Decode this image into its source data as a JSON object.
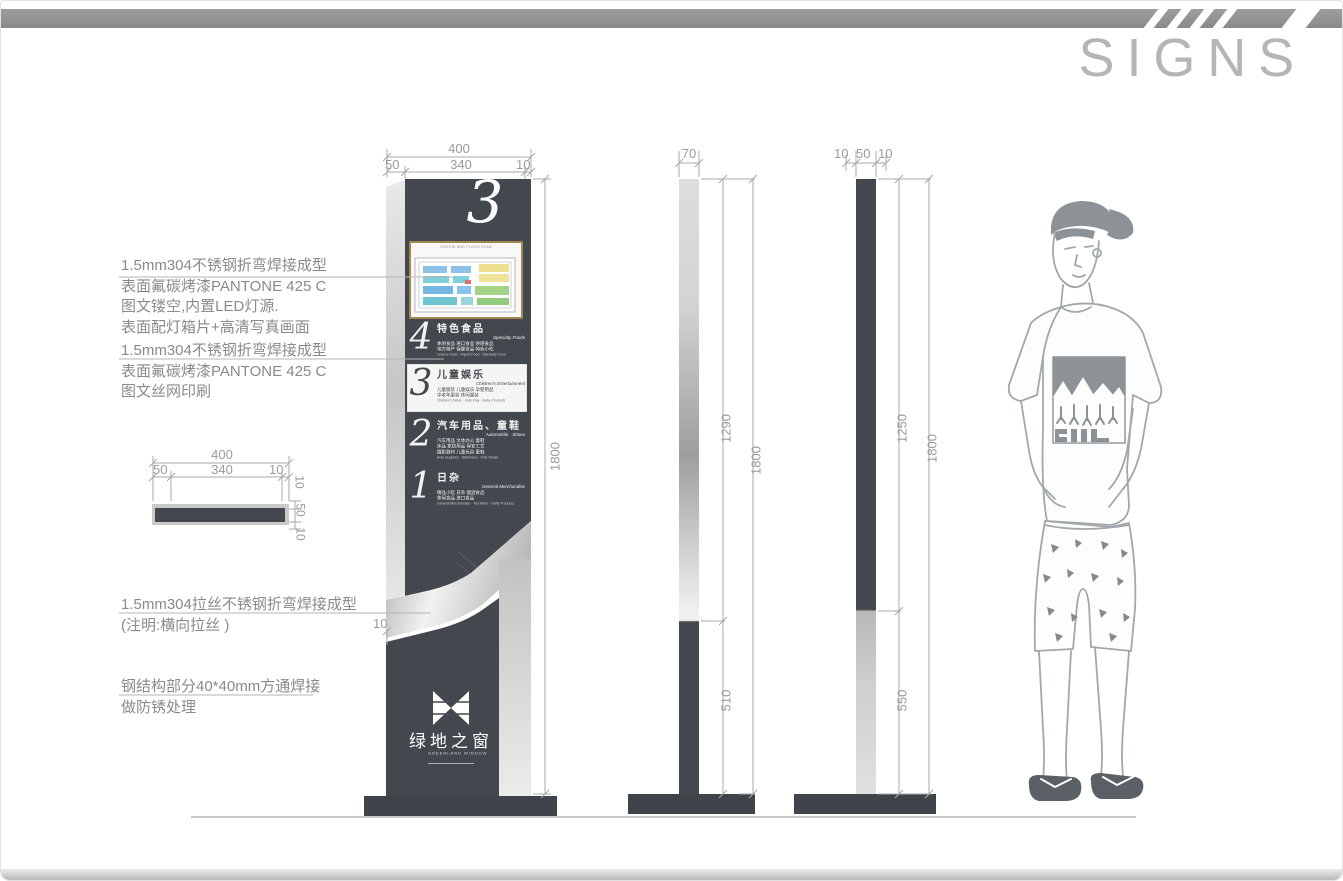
{
  "header": {
    "title": "SIGNS"
  },
  "annotations": {
    "a1": {
      "l1": "1.5mm304不锈钢折弯焊接成型",
      "l2": "表面氟碳烤漆PANTONE 425 C",
      "l3": "图文镂空,内置LED灯源.",
      "l4": "表面配灯箱片+高清写真画面"
    },
    "a2": {
      "l1": "1.5mm304不锈钢折弯焊接成型",
      "l2": "表面氟碳烤漆PANTONE 425 C",
      "l3": "图文丝网印刷"
    },
    "a3": {
      "l1": "1.5mm304拉丝不锈钢折弯焊接成型",
      "l2": "(注明:横向拉丝 )"
    },
    "a4": {
      "l1": "钢结构部分40*40mm方通焊接",
      "l2": "做防锈处理"
    }
  },
  "dimensions": {
    "front_top": {
      "overall": "400",
      "seg1": "50",
      "seg2": "340",
      "seg3": "10"
    },
    "front": {
      "height": "1800",
      "edge": "10"
    },
    "section_top": {
      "overall": "400",
      "seg1": "50",
      "seg2": "340",
      "seg3": "10"
    },
    "section_side": {
      "t1": "10",
      "t2": "50",
      "t3": "10"
    },
    "mid": {
      "width": "70",
      "upper": "1290",
      "total": "1800",
      "lower": "510"
    },
    "right": {
      "t1": "10",
      "t2": "50",
      "t3": "10",
      "upper": "1250",
      "total": "1800",
      "lower": "550"
    }
  },
  "sign": {
    "floor_numeral": "3",
    "map_title": "GREENLAND FLOOR PLAN",
    "directory": [
      {
        "num": "4",
        "title": "特色食品",
        "subtitle": "Specialty Foods",
        "line1": "休闲食品 进口食品 烘焙食品",
        "line2": "地方特产 保健食品 特色小吃",
        "en": "Leisure Food · Import Food · Specialty Food"
      },
      {
        "num": "3",
        "title": "儿童娱乐",
        "subtitle": "Children's Entertainment",
        "line1": "儿童服装 儿童娱乐 孕婴用品",
        "line2": "中老年服装 休闲服装",
        "en": "Children's Wear · Kids Play · Baby Products"
      },
      {
        "num": "2",
        "title": "汽车用品、童鞋",
        "subtitle": "Automobile · Shoes",
        "line1": "汽车用品 文体办公 童鞋",
        "line2": "床品 家纺用品 保安工艺",
        "line3": "摄影器材 儿童玩具 童鞋",
        "en": "Auto Supplies · Stationery · Kids Shoes"
      },
      {
        "num": "1",
        "title": "日杂",
        "subtitle": "General Merchandise",
        "line1": "精品小吃 日杂 烟酒食品",
        "line2": "休闲食品 进口食品",
        "en": "General Merchandise · Tea Ware · Daily Products"
      }
    ],
    "logo": {
      "cn": "绿地之窗",
      "en": "GREENLAND WINDOW"
    }
  },
  "colors": {
    "dark": "#43474e",
    "silver": "#d7d7d5",
    "gold": "#a1874e",
    "anno_text": "#8a8a8a"
  }
}
